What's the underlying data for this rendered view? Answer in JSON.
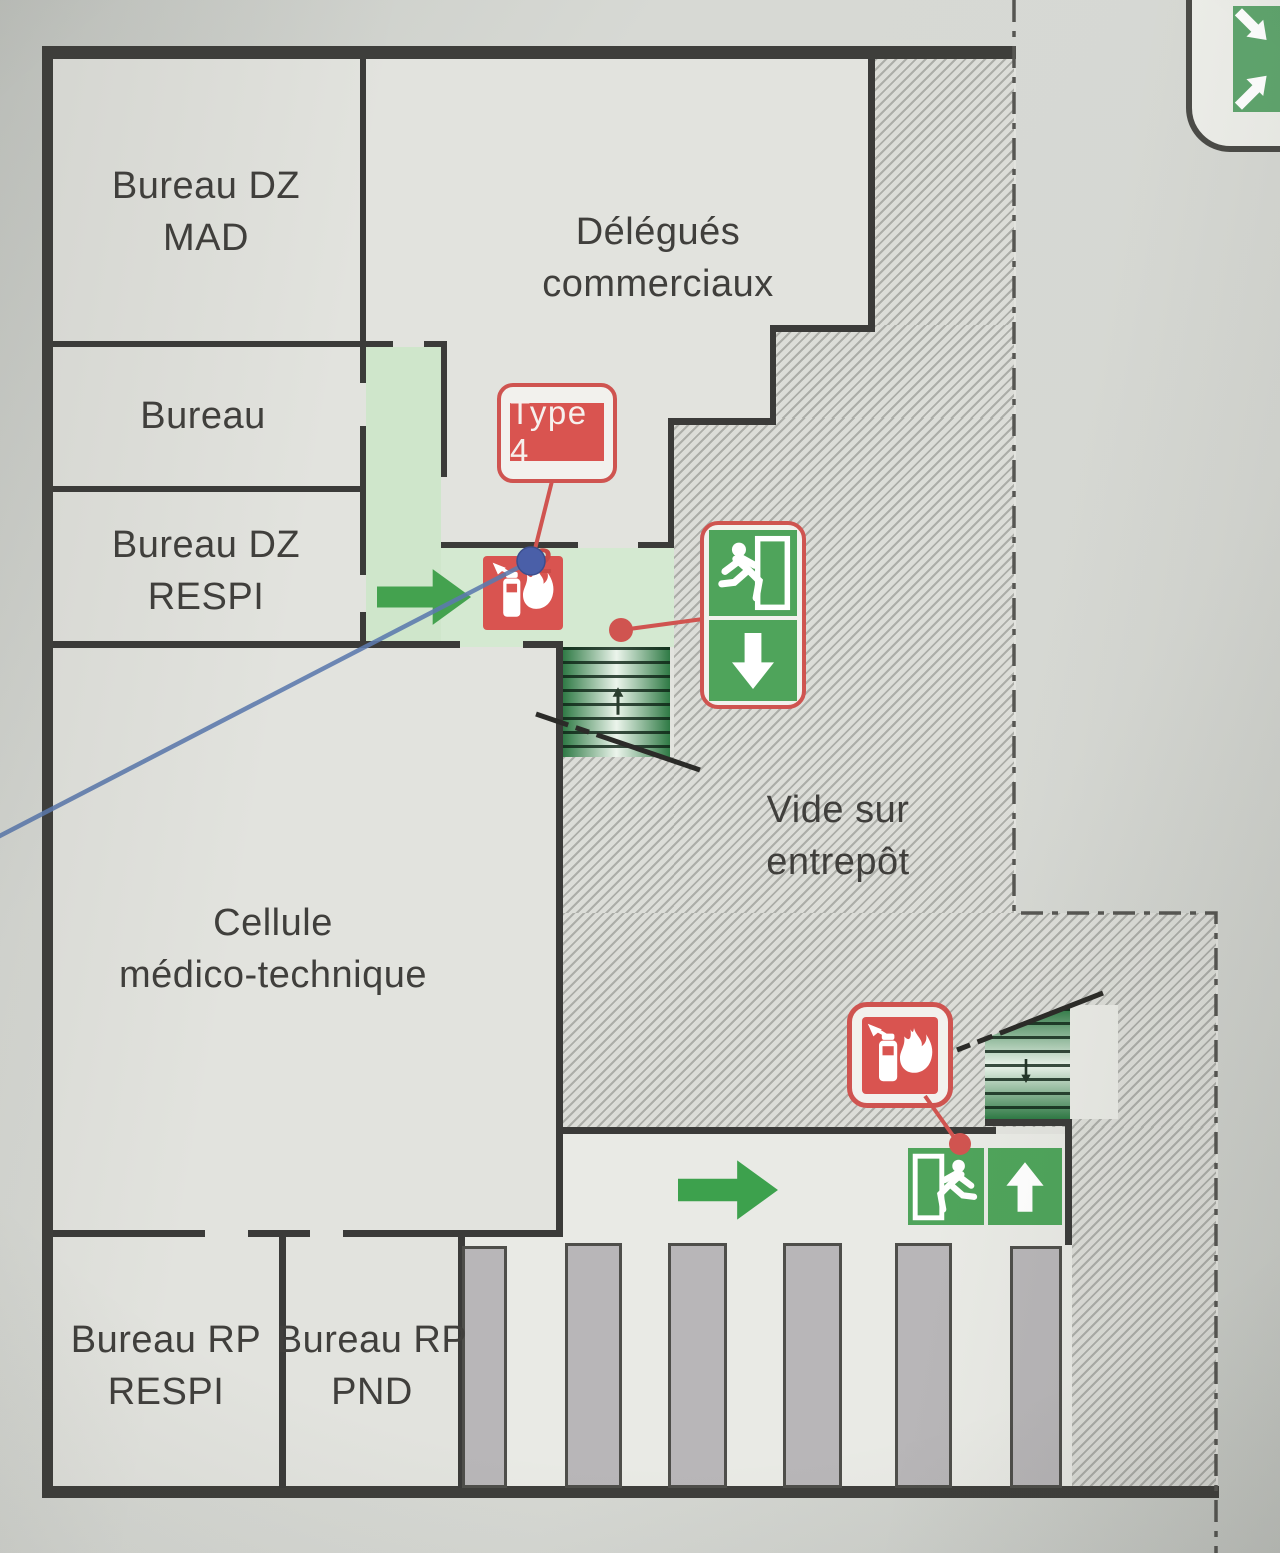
{
  "page": {
    "type": "evacuation-floor-plan"
  },
  "labels": {
    "bureau_dz_mad": {
      "line1": "Bureau DZ",
      "line2": "MAD"
    },
    "delegues_commerciaux": {
      "line1": "Délégués",
      "line2": "commerciaux"
    },
    "bureau": {
      "line1": "Bureau"
    },
    "bureau_dz_respi": {
      "line1": "Bureau DZ",
      "line2": "RESPI"
    },
    "cellule_medico_technique": {
      "line1": "Cellule",
      "line2": "médico-technique"
    },
    "vide_sur_entrepot": {
      "line1": "Vide sur",
      "line2": "entrepôt"
    },
    "bureau_rp_respi": {
      "line1": "Bureau RP",
      "line2": "RESPI"
    },
    "bureau_rp_pnd": {
      "line1": "Bureau RP",
      "line2": "PND"
    }
  },
  "annotations": {
    "equipment_type_label": "Type 4",
    "extinguisher_count": "2"
  },
  "icons": {
    "fire_extinguisher": "fire-extinguisher-icon",
    "running_man_exit": "emergency-exit-runner-icon",
    "down_arrow": "exit-direction-down-icon",
    "up_arrow": "exit-direction-up-icon",
    "right_arrow": "evacuation-direction-right-icon",
    "assembly_point": "assembly-point-icon",
    "stairs": "stairs-icon"
  },
  "colors": {
    "safety_green": "#4fa45b",
    "corridor_green": "#cfe6cb",
    "alarm_red": "#d05450",
    "wall_dark": "#3b3b39",
    "floor": "#e2e3de",
    "hatch_line": "#b2b3ae",
    "callout_blue": "#5c7aae",
    "pillar_grey": "#b8b6b8"
  }
}
